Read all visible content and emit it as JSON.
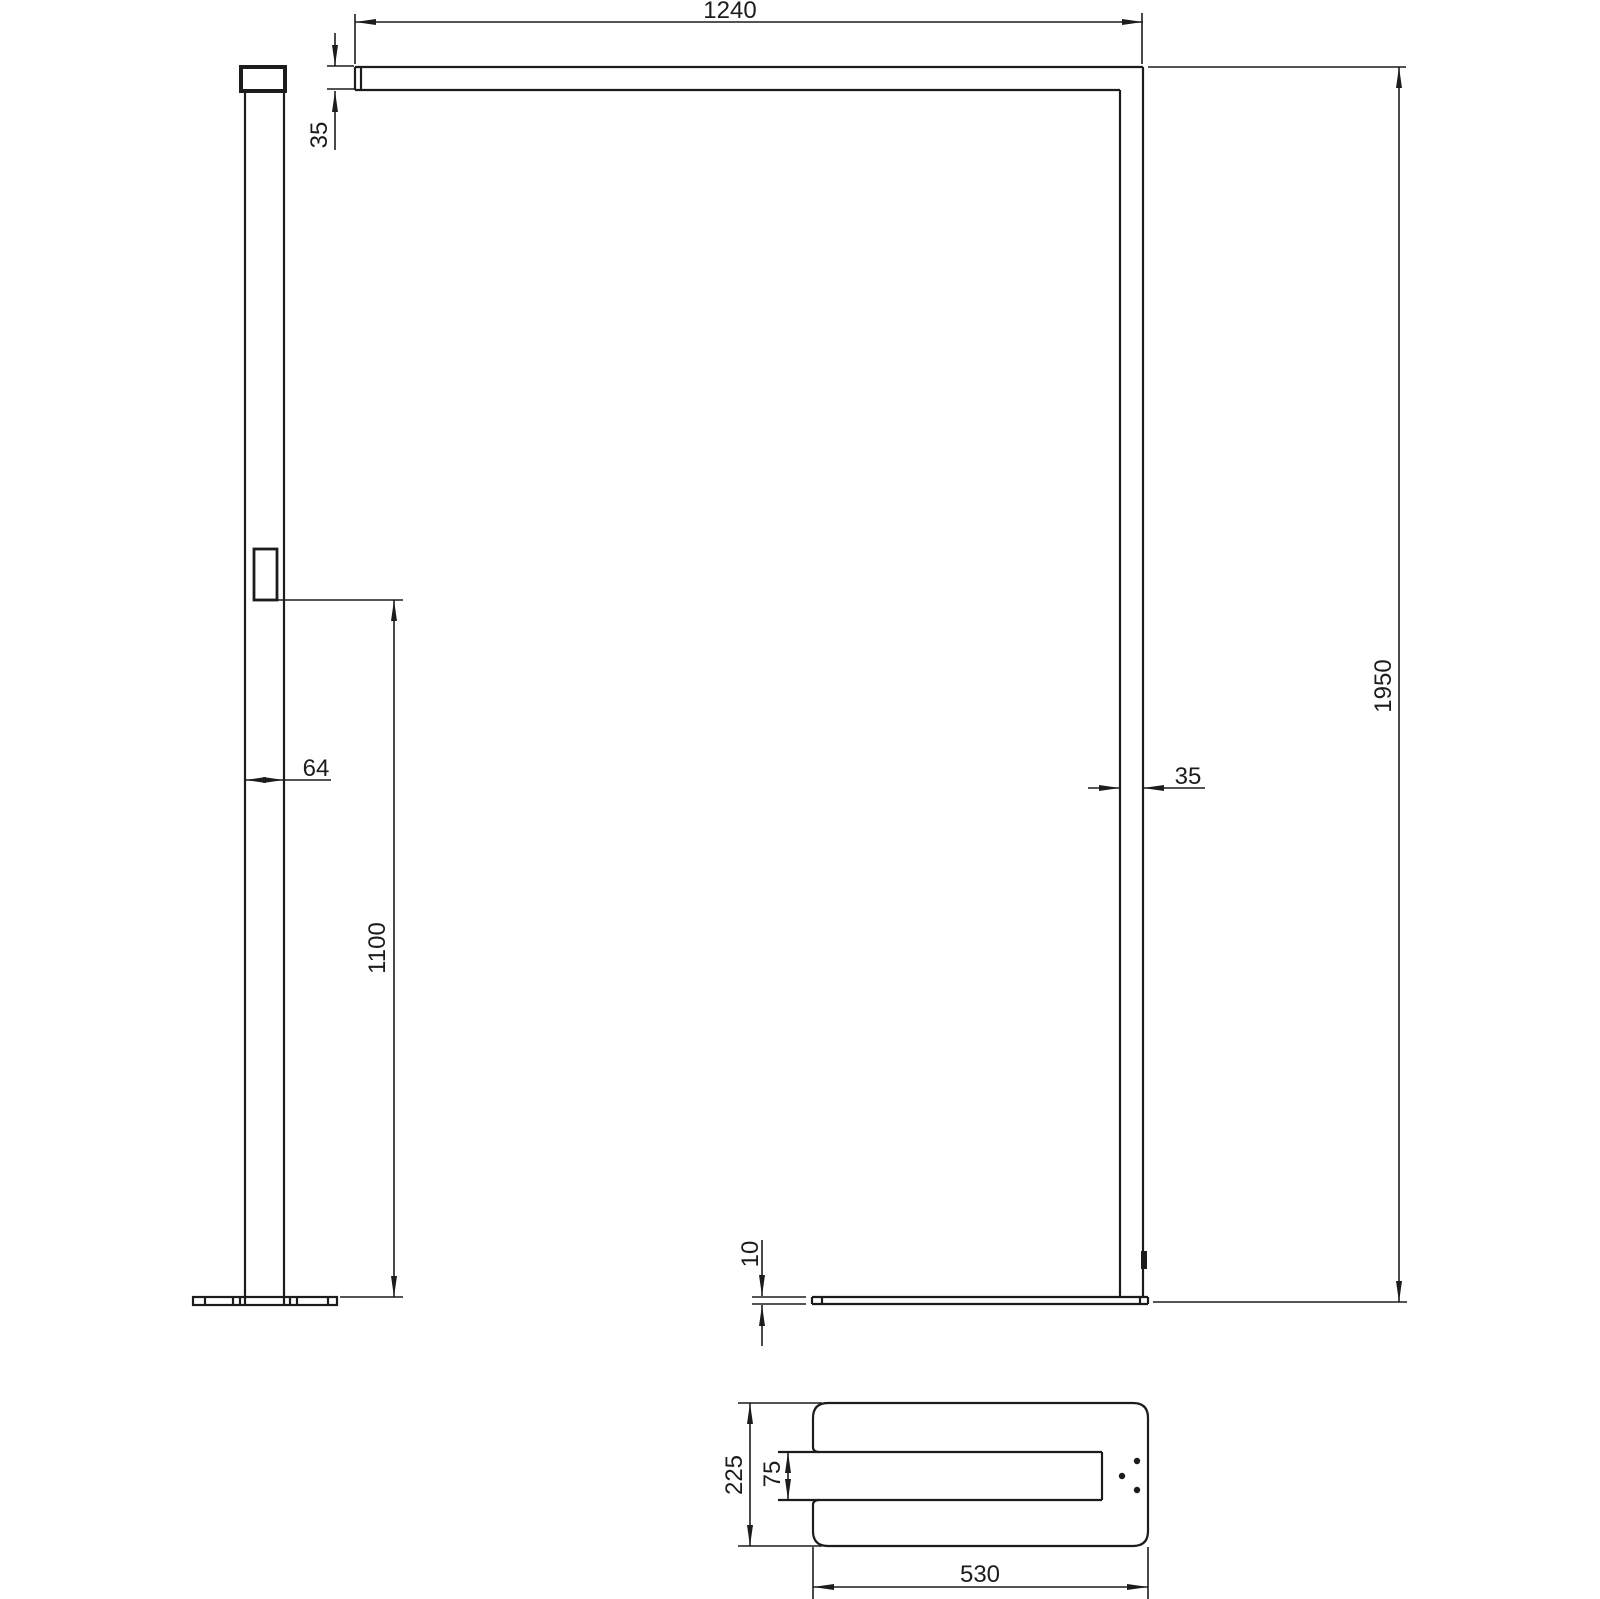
{
  "drawing": {
    "kind": "floor-lamp-technical-drawing",
    "colors": {
      "line": "#1c1c1c",
      "background": "#ffffff"
    },
    "dimensions": {
      "luminaire_length": "1240",
      "head_height": "35",
      "pole_depth": "64",
      "control_height": "1100",
      "total_height": "1950",
      "pole_width": "35",
      "base_thickness": "10",
      "base_depth": "225",
      "base_slot_width": "75",
      "base_length": "530"
    }
  }
}
